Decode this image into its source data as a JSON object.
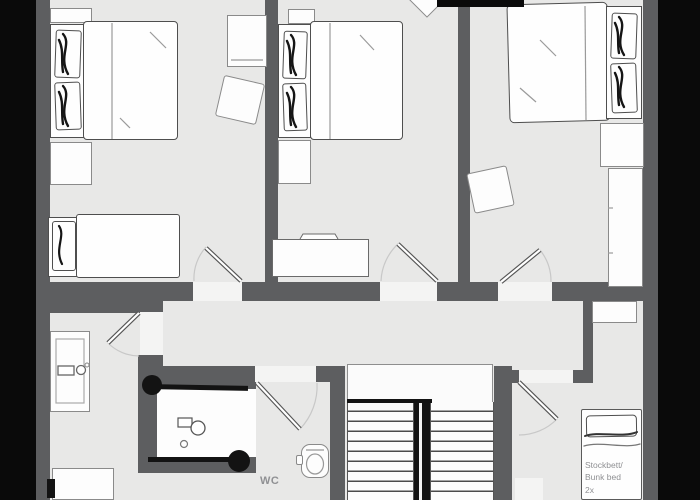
{
  "meta": {
    "type": "floor-plan",
    "style": "sketch-furniture-on-gray-plan"
  },
  "palette": {
    "background": "#0a0a0a",
    "wall": "#5d5e60",
    "floor": "#e8e8e7",
    "door_opening": "#f4f4f3",
    "furniture": "#fefefe",
    "ink": "#131313",
    "door_arc": "#c8c8c8",
    "label_text": "#8f9093"
  },
  "labels": {
    "wc": "WC",
    "bunk": {
      "line1": "Stockbett/",
      "line2": "Bunk bed",
      "line3": "2x"
    }
  },
  "icons": {
    "double-bed": "sketch-rect-with-pillows",
    "single-bed": "sketch-rect-with-pillow",
    "bunk-bed": "sketch-rect-with-pillow",
    "nightstand": "small-white-rect",
    "wardrobe": "white-rect-thin-outline",
    "dresser": "white-rect-notched",
    "stool": "rotated-white-square",
    "vanity-sink": "rect-with-faucet-glyph",
    "shower": "black-framed-enclosure-with-head-glyph",
    "toilet": "rounded-rect-with-ellipse",
    "staircase": "striped-treads-with-black-divider",
    "door": "svg-leaf-with-quarter-arc"
  }
}
